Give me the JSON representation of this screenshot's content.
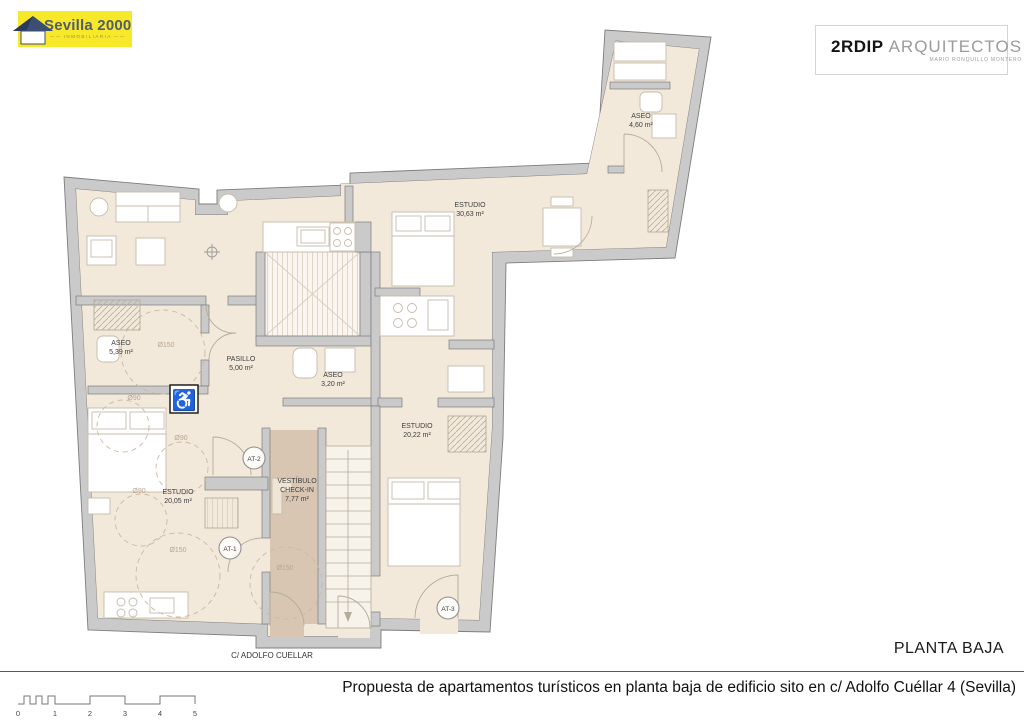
{
  "branding": {
    "agency": {
      "name": "Sevilla 2000",
      "tagline": "INMOBILIARIA"
    },
    "architect": {
      "name_bold": "2RDIP",
      "name_light": "ARQUITECTOS",
      "subtitle": "MARIO RONQUILLO MONTERO"
    }
  },
  "plan": {
    "floor_label": "PLANTA BAJA",
    "street_label": "C/ ADOLFO CUELLAR",
    "footer_title": "Propuesta de apartamentos turísticos en planta baja de edificio sito en c/ Adolfo Cuéllar 4 (Sevilla)",
    "rooms": [
      {
        "name": "ASEO",
        "area": "4,60 m²"
      },
      {
        "name": "ESTUDIO",
        "area": "30,63 m²"
      },
      {
        "name": "ASEO",
        "area": "5,39 m²"
      },
      {
        "name": "PASILLO",
        "area": "5,00 m²"
      },
      {
        "name": "ASEO",
        "area": "3,20 m²"
      },
      {
        "name": "ESTUDIO",
        "area": "20,22 m²"
      },
      {
        "name": "ESTUDIO",
        "area": "20,05 m²"
      },
      {
        "name": "VESTÍBULO",
        "name2": "CHECK-IN",
        "area": "7,77 m²"
      }
    ],
    "units": [
      "AT-1",
      "AT-2",
      "AT-3"
    ],
    "diameter_labels": [
      "Ø150",
      "Ø90",
      "Ø90",
      "Ø90",
      "Ø150",
      "Ø150"
    ],
    "accessibility_glyph": "♿"
  },
  "scale_bar": {
    "ticks": [
      "0",
      "1",
      "2",
      "3",
      "4",
      "5"
    ]
  },
  "colors": {
    "wall": "#cacaca",
    "floor": "#f3e9da",
    "vestibule_floor": "#d9c6b2",
    "logo_yellow": "#f7e829",
    "logo_roof_blue": "#3d4e73"
  }
}
